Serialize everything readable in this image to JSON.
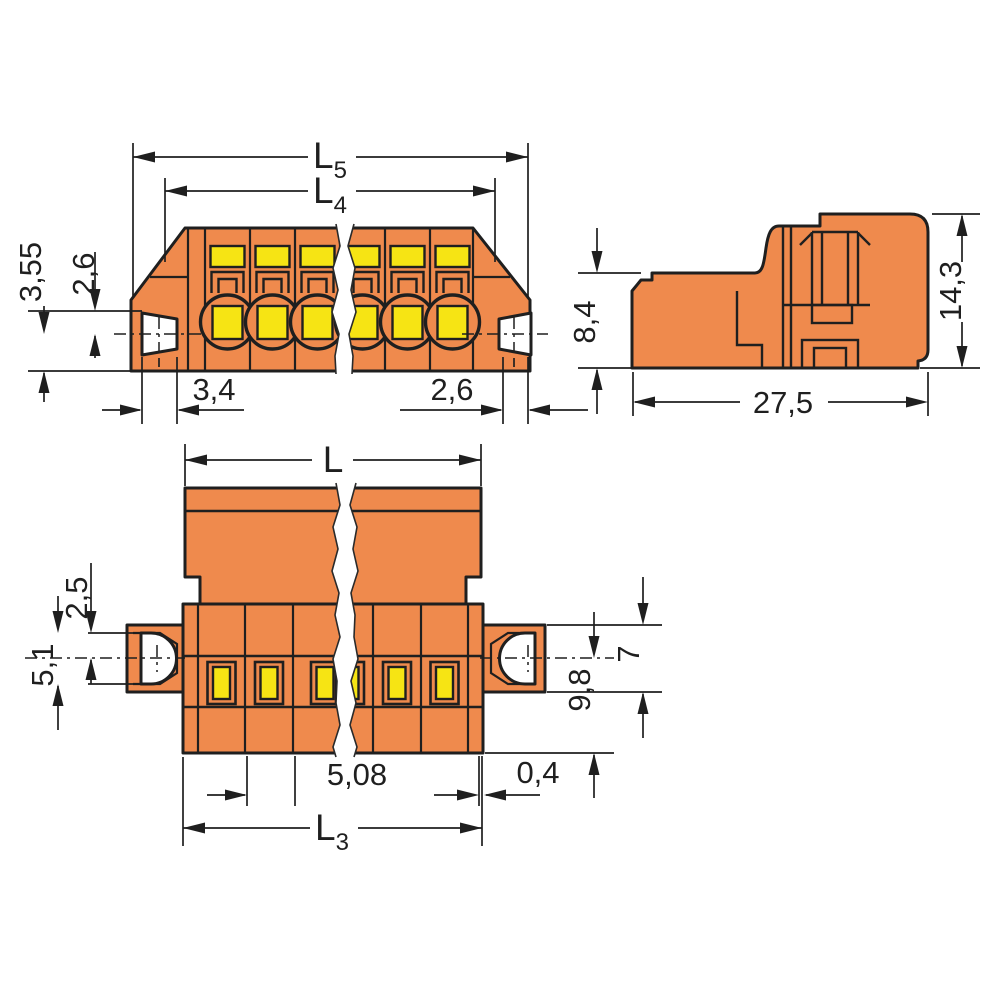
{
  "drawing": {
    "type": "technical-dimension-drawing",
    "front_view": {
      "poles_visible": 6,
      "label_l5_main": "L",
      "label_l5_sub": "5",
      "label_l4_main": "L",
      "label_l4_sub": "4",
      "label_3_55": "3,55",
      "label_2_6_left": "2,6",
      "label_3_4": "3,4",
      "label_2_6_right": "2,6"
    },
    "side_view": {
      "label_8_4": "8,4",
      "label_14_3": "14,3",
      "label_27_5": "27,5"
    },
    "bottom_view": {
      "slots_visible": 6,
      "label_l": "L",
      "label_2_5": "2,5",
      "label_5_1": "5,1",
      "label_7": "7",
      "label_9_8": "9,8",
      "label_5_08": "5,08",
      "label_0_4": "0,4",
      "label_l3_main": "L",
      "label_l3_sub": "3"
    },
    "colors": {
      "body_orange": "#EF8A4D",
      "contact_yellow": "#F6E414",
      "line": "#1F1F1F"
    }
  }
}
